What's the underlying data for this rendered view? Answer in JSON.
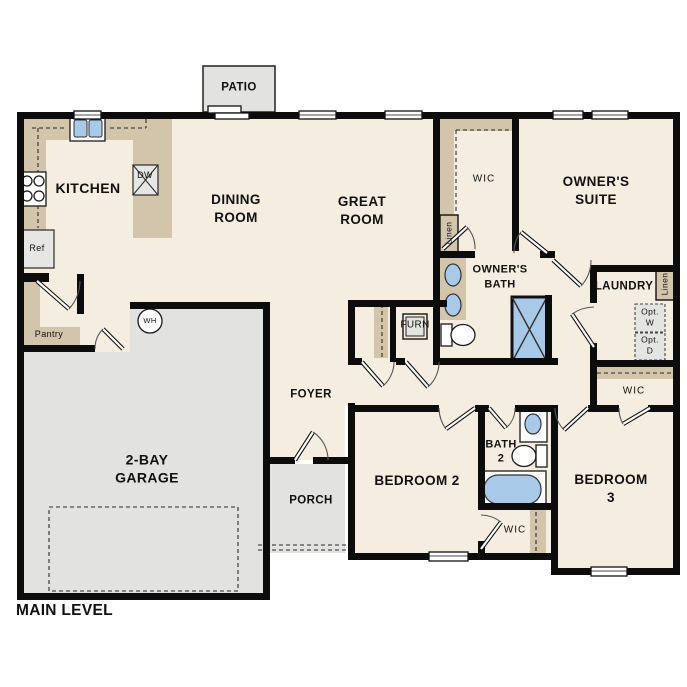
{
  "colors": {
    "floor": "#f5eee0",
    "concrete": "#e2e2e0",
    "counter_tan": "#d2c5ab",
    "fixture_blue": "#a9c9e9",
    "wall": "#0c0c0c"
  },
  "rooms": {
    "patio": "PATIO",
    "kitchen": "KITCHEN",
    "dining_room": "DINING\nROOM",
    "great_room": "GREAT\nROOM",
    "owners_suite": "OWNER'S\nSUITE",
    "owners_wic": "WIC",
    "owners_bath": "OWNER'S\nBATH",
    "laundry": "LAUNDRY",
    "foyer": "FOYER",
    "porch": "PORCH",
    "garage": "2-BAY\nGARAGE",
    "bedroom2": "BEDROOM 2",
    "bath2": "BATH\n2",
    "bedroom3": "BEDROOM 3",
    "bedroom2_wic": "WIC",
    "bedroom3_wic": "WIC"
  },
  "fixtures": {
    "refrigerator": "Ref",
    "dishwasher": "DW",
    "water_heater": "WH",
    "furnace": "FURN",
    "pantry": "Pantry",
    "owners_wic_linen": "Linen",
    "laundry_linen": "Linen",
    "optional_washer": "Opt.\nW",
    "optional_dryer": "Opt.\nD"
  },
  "footer": {
    "level_label": "MAIN LEVEL"
  }
}
